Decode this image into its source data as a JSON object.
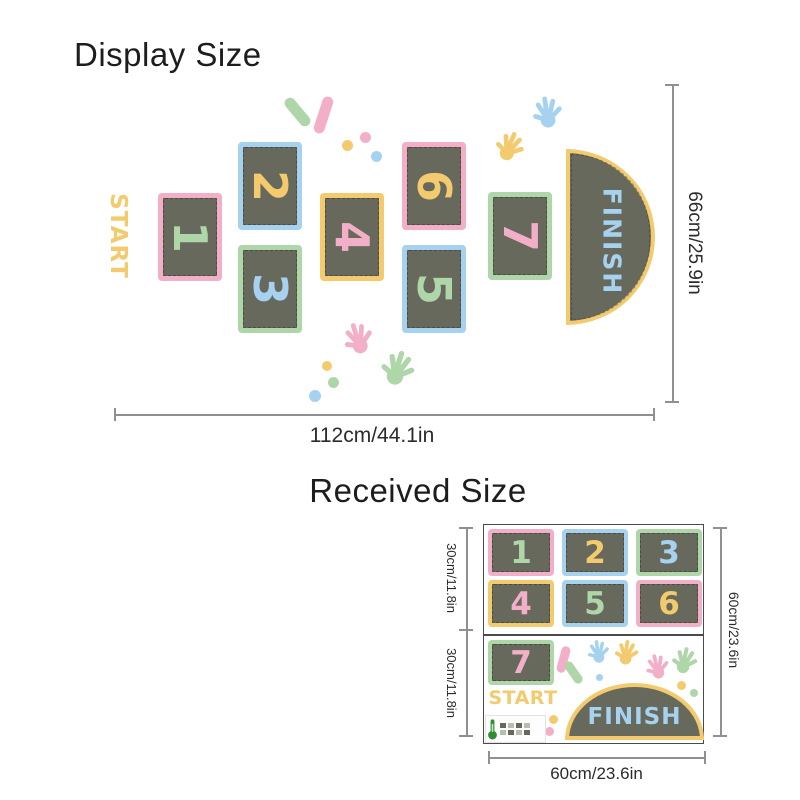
{
  "display": {
    "heading": "Display Size",
    "start_label": "START",
    "finish_label": "FINISH",
    "tiles": [
      "1",
      "2",
      "3",
      "4",
      "5",
      "6",
      "7"
    ],
    "width_label": "112cm/44.1in",
    "height_label": "66cm/25.9in"
  },
  "received": {
    "heading": "Received Size",
    "start_label": "START",
    "finish_label": "FINISH",
    "tiles": [
      "1",
      "2",
      "3",
      "4",
      "5",
      "6",
      "7"
    ],
    "width_label": "60cm/23.6in",
    "height_label": "60cm/23.6in",
    "upper_half_label": "30cm/11.8in",
    "lower_half_label": "30cm/11.8in"
  },
  "palette": {
    "pink": "#F2AFC7",
    "blue": "#A6D2F0",
    "green": "#AFD6A8",
    "yellow": "#F3CB6E",
    "tile_fill": "#67695D"
  }
}
